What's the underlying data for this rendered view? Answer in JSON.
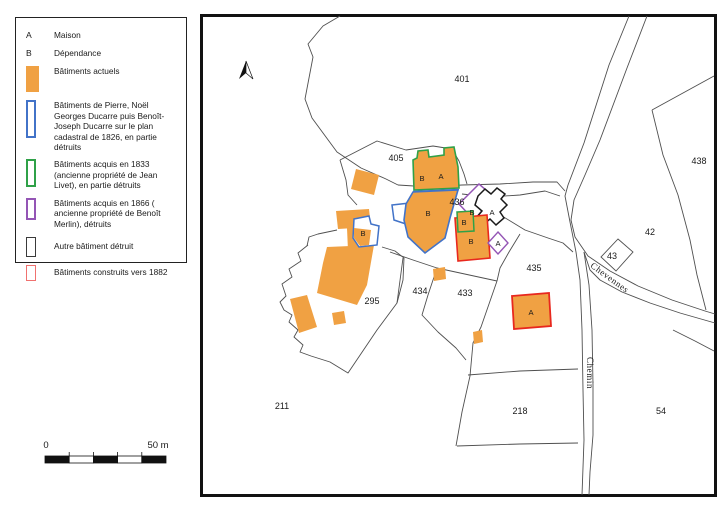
{
  "legend": {
    "items": [
      {
        "type": "letter",
        "symbol": "A",
        "label": "Maison"
      },
      {
        "type": "letter",
        "symbol": "B",
        "label": "Dépendance"
      },
      {
        "type": "fill",
        "color": "#F0A143",
        "label": "Bâtiments actuels"
      },
      {
        "type": "outline",
        "color": "#4273C8",
        "label": "Bâtiments de Pierre, Noël Georges Ducarre puis Benoît-Joseph Ducarre sur le plan cadastral de 1826, en partie détruits"
      },
      {
        "type": "outline",
        "color": "#2FA148",
        "label": "Bâtiments acquis en 1833 (ancienne propriété de Jean Livet), en partie détruits"
      },
      {
        "type": "outline",
        "color": "#9455B5",
        "label": "Bâtiments acquis en 1866 ( ancienne propriété de Benoît Merlin), détruits"
      },
      {
        "type": "outline",
        "color": "#3A3A3A",
        "label": "Autre bâtiment détruit"
      },
      {
        "type": "outline",
        "color": "#F0716F",
        "label": "Bâtiments construits vers 1882"
      }
    ]
  },
  "scale_bar": {
    "start_label": "0",
    "end_label": "50 m"
  },
  "map": {
    "parcels": {
      "p401": "401",
      "p405": "405",
      "p436": "436",
      "p438": "438",
      "p42": "42",
      "p43": "43",
      "p435": "435",
      "p434": "434",
      "p433": "433",
      "p295": "295",
      "p211": "211",
      "p218": "218",
      "p54": "54"
    },
    "roads": {
      "chevennes": "Chevennes",
      "chemin": "Chemin"
    },
    "building_letters": {
      "green_b": "B",
      "green_a": "A",
      "blue_b": "B",
      "west_b": "B",
      "merlin_b": "B",
      "black_a": "A",
      "small_green_b": "B",
      "red_b": "B",
      "diamond_a": "A",
      "red_a": "A"
    }
  },
  "colors": {
    "building_current": "#F0A143",
    "ducarre_1826": "#4273C8",
    "livet_1833": "#2FA148",
    "merlin_1866": "#9455B5",
    "other_destroyed": "#1A1A1A",
    "built_1882": "#E8281E",
    "legend_1882_swatch": "#F0716F",
    "parcel_line": "#4F4F4F"
  }
}
